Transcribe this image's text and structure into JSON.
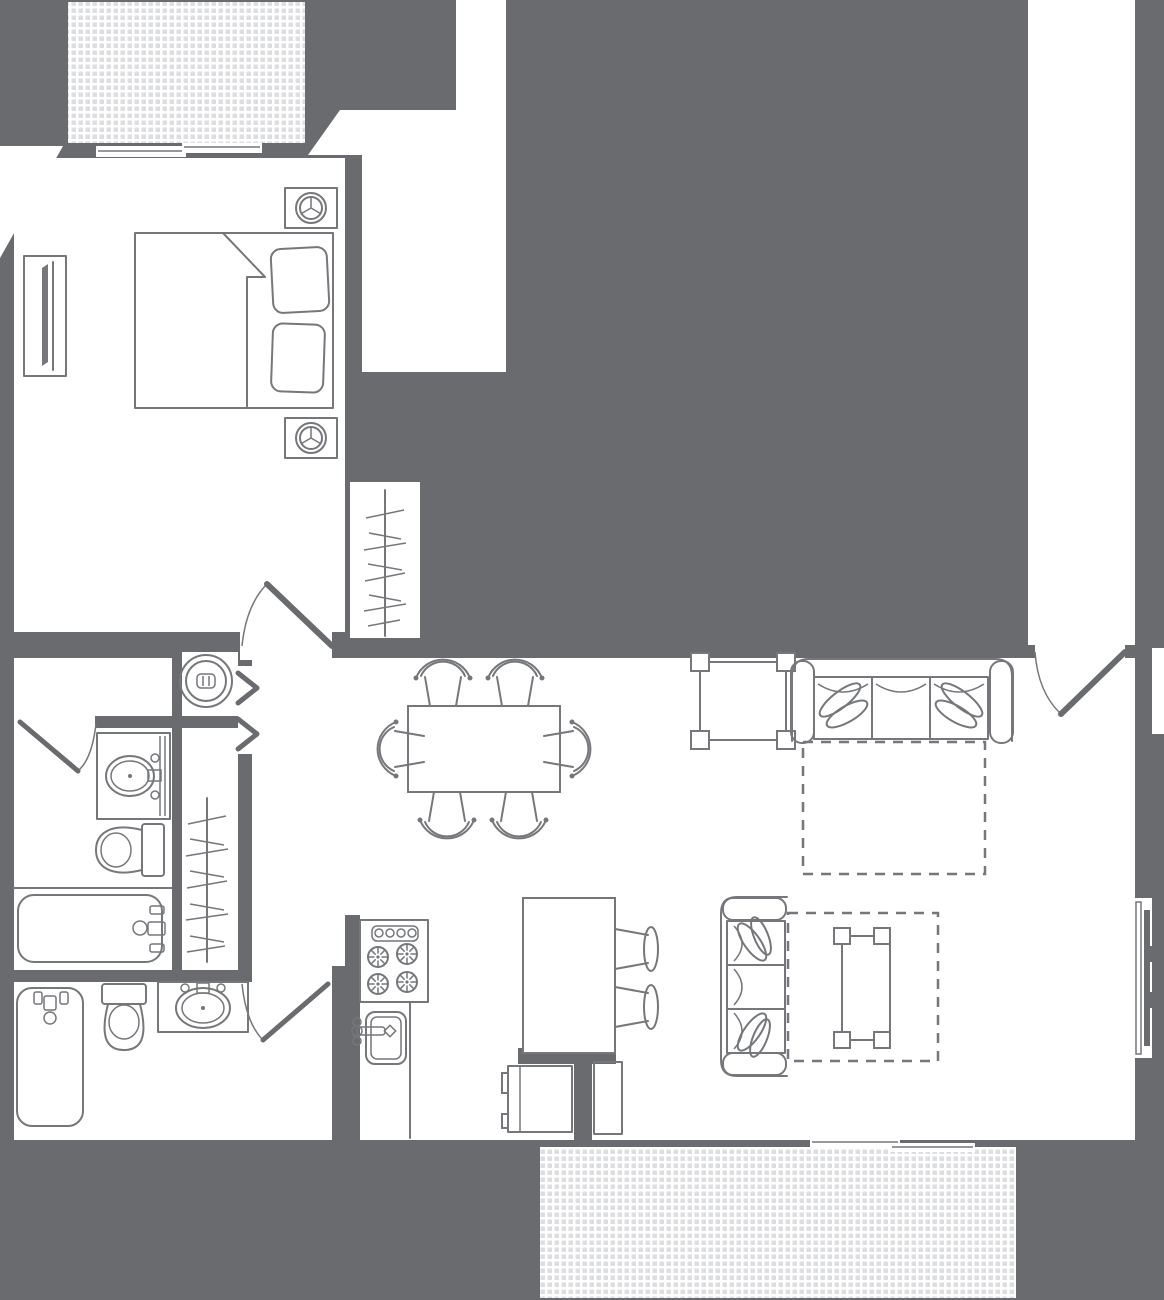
{
  "document": {
    "kind": "apartment-floor-plan",
    "view": "top-down-2d",
    "has_text": false
  },
  "colors": {
    "background": "#696b6e",
    "room_fill": "#ffffff",
    "line": "#75777a",
    "line_soft": "#8a8c8f",
    "hatch_tile": "#dcdee0",
    "hatch_grout": "#ffffff",
    "rug_dash": "#75777a"
  },
  "areas": [
    {
      "id": "balcony-top",
      "label": "hatched balcony at top"
    },
    {
      "id": "bedroom",
      "label": "bedroom"
    },
    {
      "id": "bedroom-closet",
      "label": "closet with hanging rod"
    },
    {
      "id": "hall-and-bath-1",
      "label": "hall with bathroom (vanity, toilet, tub)"
    },
    {
      "id": "laundry-closet",
      "label": "laundry closet with washer"
    },
    {
      "id": "linen-closet",
      "label": "closet with hanging rod"
    },
    {
      "id": "bathroom-2",
      "label": "second bathroom (tub, toilet, vanity)"
    },
    {
      "id": "living-dining-kitchen",
      "label": "open living / dining / kitchen"
    },
    {
      "id": "entry-corridor",
      "label": "entry corridor at top right"
    },
    {
      "id": "patio-bottom",
      "label": "hatched patio at bottom"
    }
  ],
  "furniture_icons": [
    "bed-icon",
    "pillow-icon",
    "nightstand-lamp-icon",
    "tv-console-icon",
    "washer-icon",
    "bifold-door-icon",
    "hanging-rod-icon",
    "vanity-sink-icon",
    "toilet-icon",
    "bathtub-icon",
    "dining-table-icon",
    "dining-chair-icon",
    "sofa-icon",
    "throw-pillow-icon",
    "end-table-icon",
    "rug-outline-icon",
    "coffee-table-icon",
    "range-burners-icon",
    "kitchen-sink-icon",
    "island-counter-icon",
    "bar-stool-icon",
    "refrigerator-icon",
    "cabinet-icon",
    "wall-tv-icon",
    "door-swing-icon",
    "window-icon",
    "sliding-door-icon"
  ],
  "counts": {
    "sofas": 2,
    "rugs_dashed": 2,
    "dining_chairs": 6,
    "bar_stools": 2,
    "toilets": 2,
    "bathtubs": 2,
    "vanity_sinks": 2,
    "burners": 4,
    "closet_rods": 2,
    "balconies_hatched": 2,
    "nightstand_lamps": 2
  }
}
